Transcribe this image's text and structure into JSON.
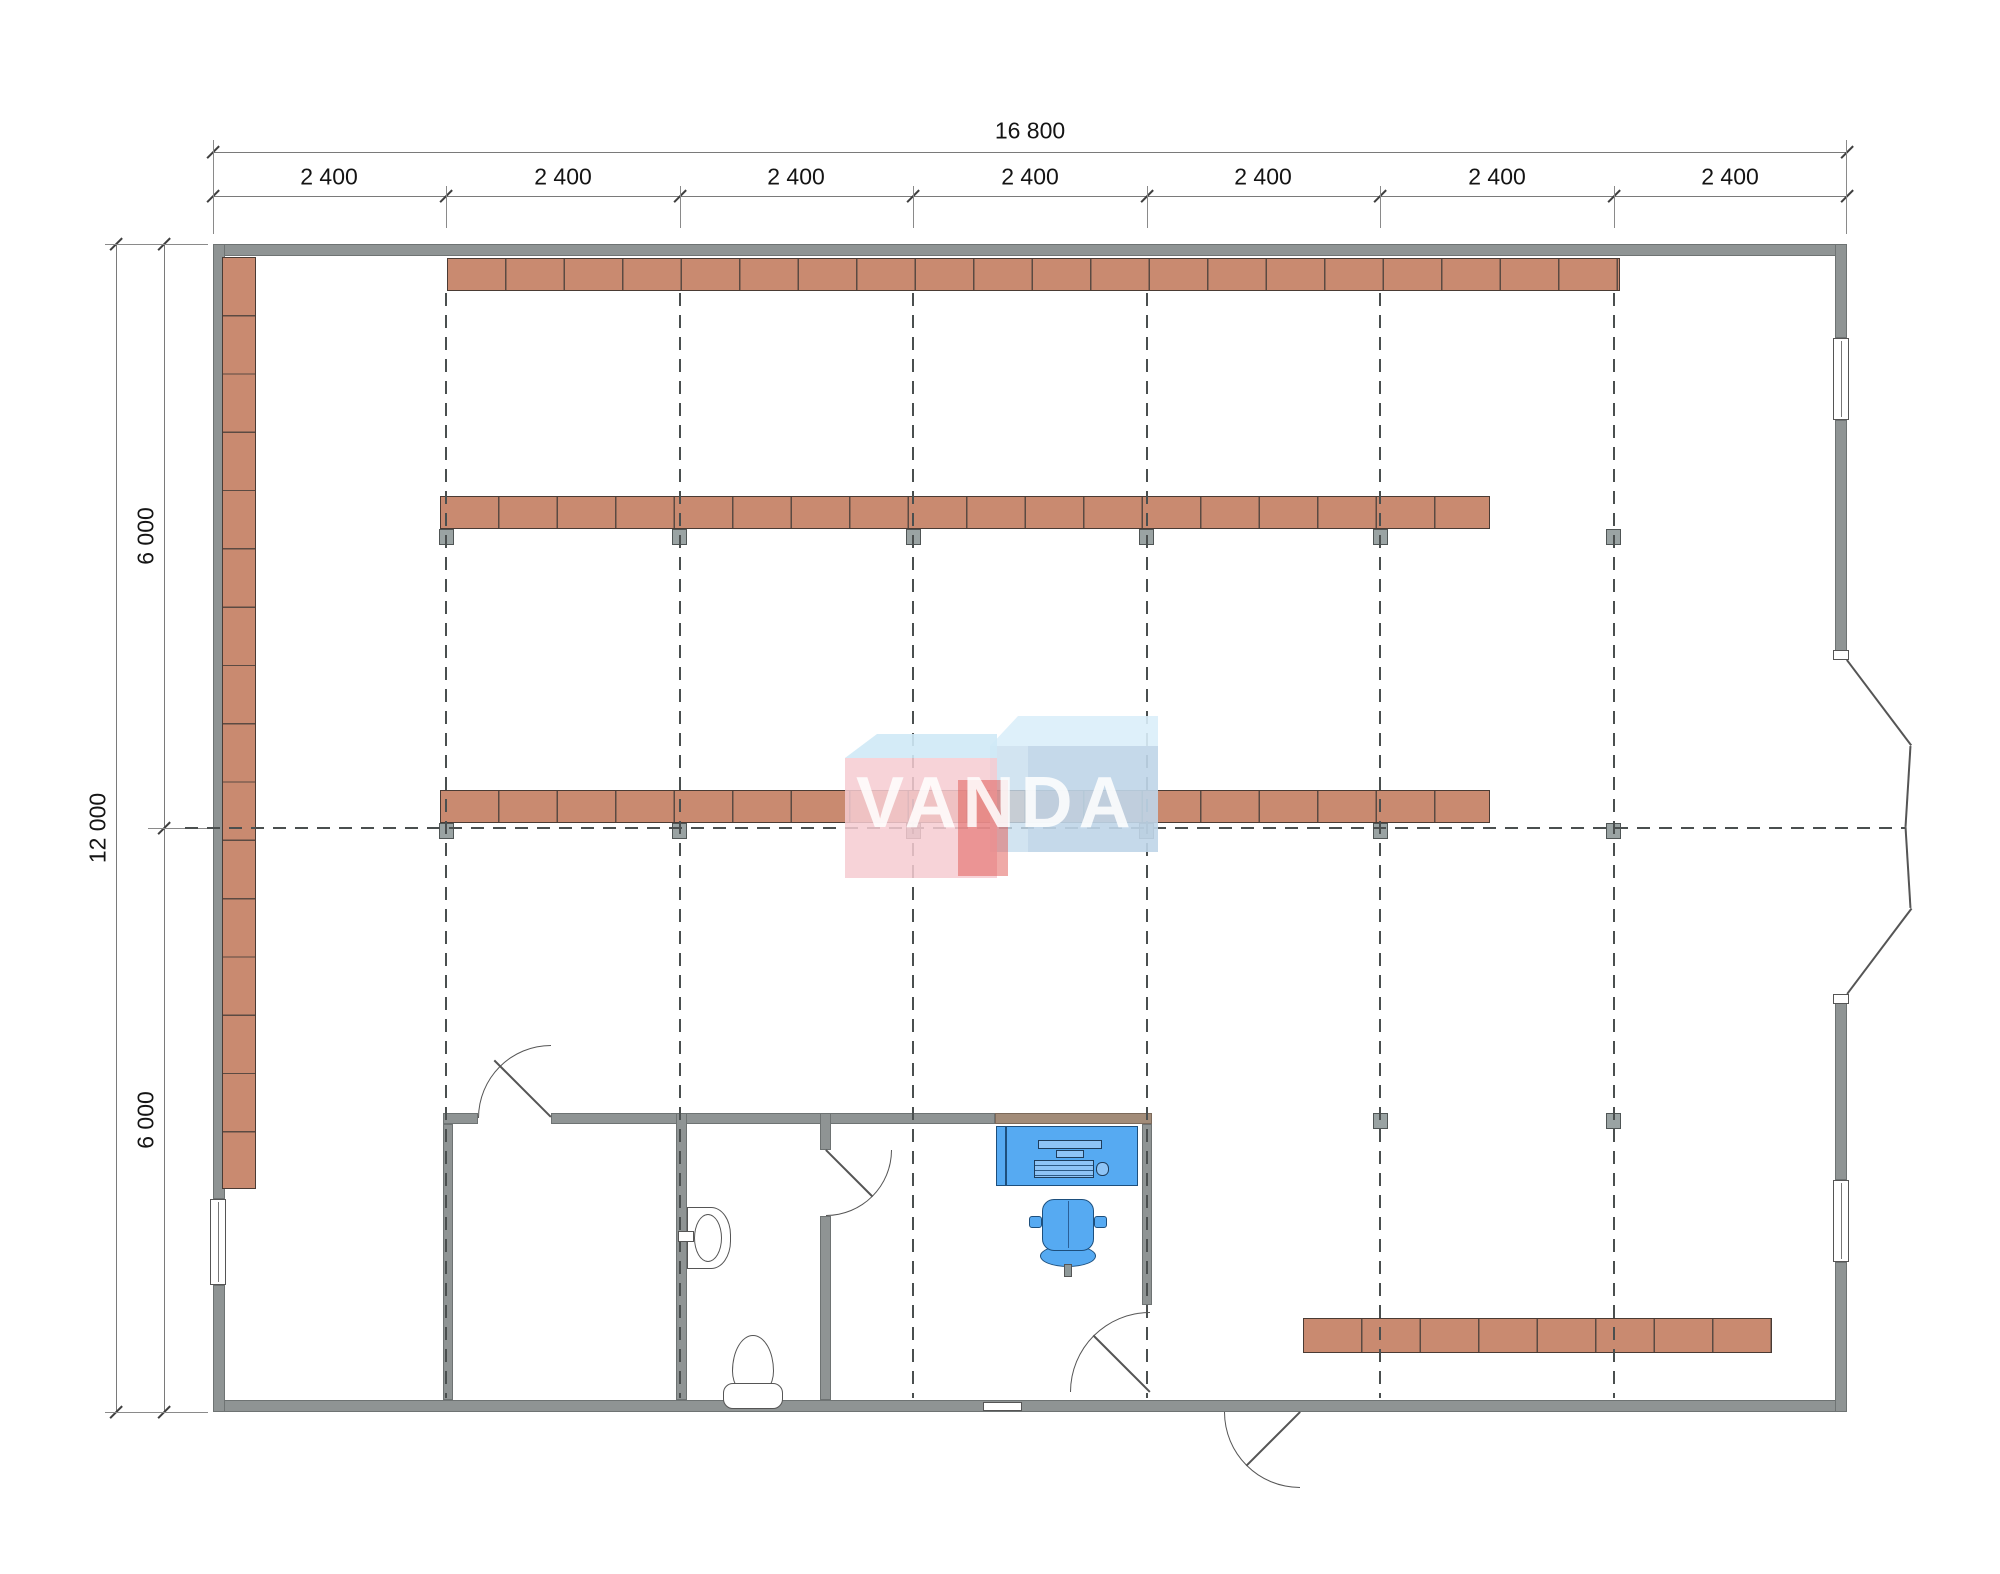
{
  "title": "VANDA retail floor plan",
  "watermark": {
    "text": "VANDA"
  },
  "dims": {
    "total_width": "16 800",
    "bays": [
      "2 400",
      "2 400",
      "2 400",
      "2 400",
      "2 400",
      "2 400",
      "2 400"
    ],
    "total_height": "12 000",
    "halves": [
      "6 000",
      "6 000"
    ]
  },
  "colors": {
    "wall": "#8f9494",
    "shelf": "#c98a70",
    "desk_and_chair": "#56aaf2",
    "grid_line": "#4a4f4f",
    "logo_pink": "#f6cbd1",
    "logo_blue": "#c7ddee",
    "logo_red": "#e0564f"
  },
  "plan": {
    "shelf_rows": [
      {
        "name": "left-wall-shelf",
        "segments": 16
      },
      {
        "name": "top-wall-shelf",
        "segments": 20
      },
      {
        "name": "middle-shelf-upper",
        "segments": 18
      },
      {
        "name": "middle-shelf-lower",
        "segments": 18
      },
      {
        "name": "bottom-right-shelf",
        "segments": 8
      }
    ],
    "fixtures": [
      "toilet",
      "sink",
      "desk-with-computer",
      "office-chair"
    ],
    "doors": [
      "storage-room-door",
      "wc-door",
      "office-door",
      "entrance-door",
      "double-exit-door"
    ],
    "windows": 3,
    "columns": 14
  }
}
